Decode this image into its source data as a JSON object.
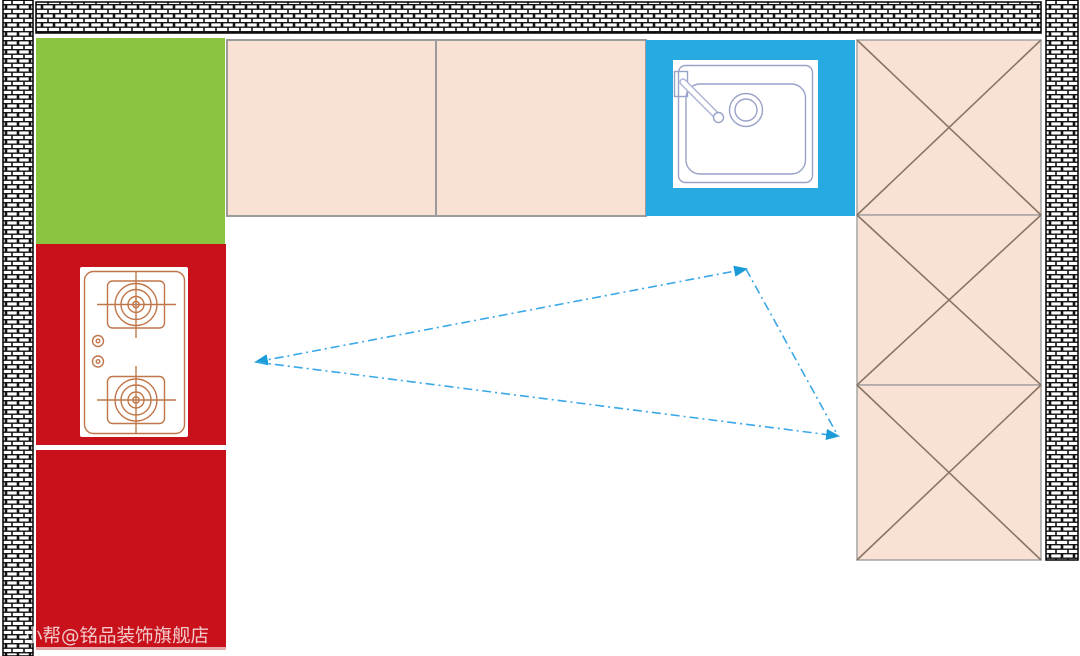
{
  "canvas": {
    "width": 1080,
    "height": 656,
    "background": "#ffffff"
  },
  "colors": {
    "wall_mortar": "#141414",
    "wall_brick": "#ffffff",
    "green_block": "#8BC53F",
    "red_block": "#C8111A",
    "red_block_bottom_edge": "#E5A9A9",
    "sink_blue": "#27A9E1",
    "counter_peach": "#F9E1D3",
    "counter_border": "#9B9B9B",
    "cabinet_border": "#A5A5A5",
    "cabinet_cross_line": "#8A7565",
    "stove_line": "#C0764A",
    "sink_line": "#99A2C8",
    "sink_spout_outline": "#AEB5D8",
    "triangle_line": "#3AA8E6",
    "triangle_arrow": "#1B9CD8"
  },
  "watermark": {
    "text": "小帮@铭品装饰旗舰店"
  },
  "diagram": {
    "type": "kitchen-floor-plan",
    "zones": {
      "green_block": "tall-cabinet-or-fridge",
      "red_block": "cooktop-zone-with-2-burner-gas-stove",
      "blue_block": "sink-zone",
      "peach_counters_top": 2,
      "peach_cabinet_squares_right": 3
    },
    "work_triangle": {
      "style": "dash-dot",
      "vertices": [
        {
          "name": "left",
          "x": 256,
          "y": 362
        },
        {
          "name": "top-right",
          "x": 746,
          "y": 269
        },
        {
          "name": "bottom-right",
          "x": 838,
          "y": 436
        }
      ]
    }
  }
}
